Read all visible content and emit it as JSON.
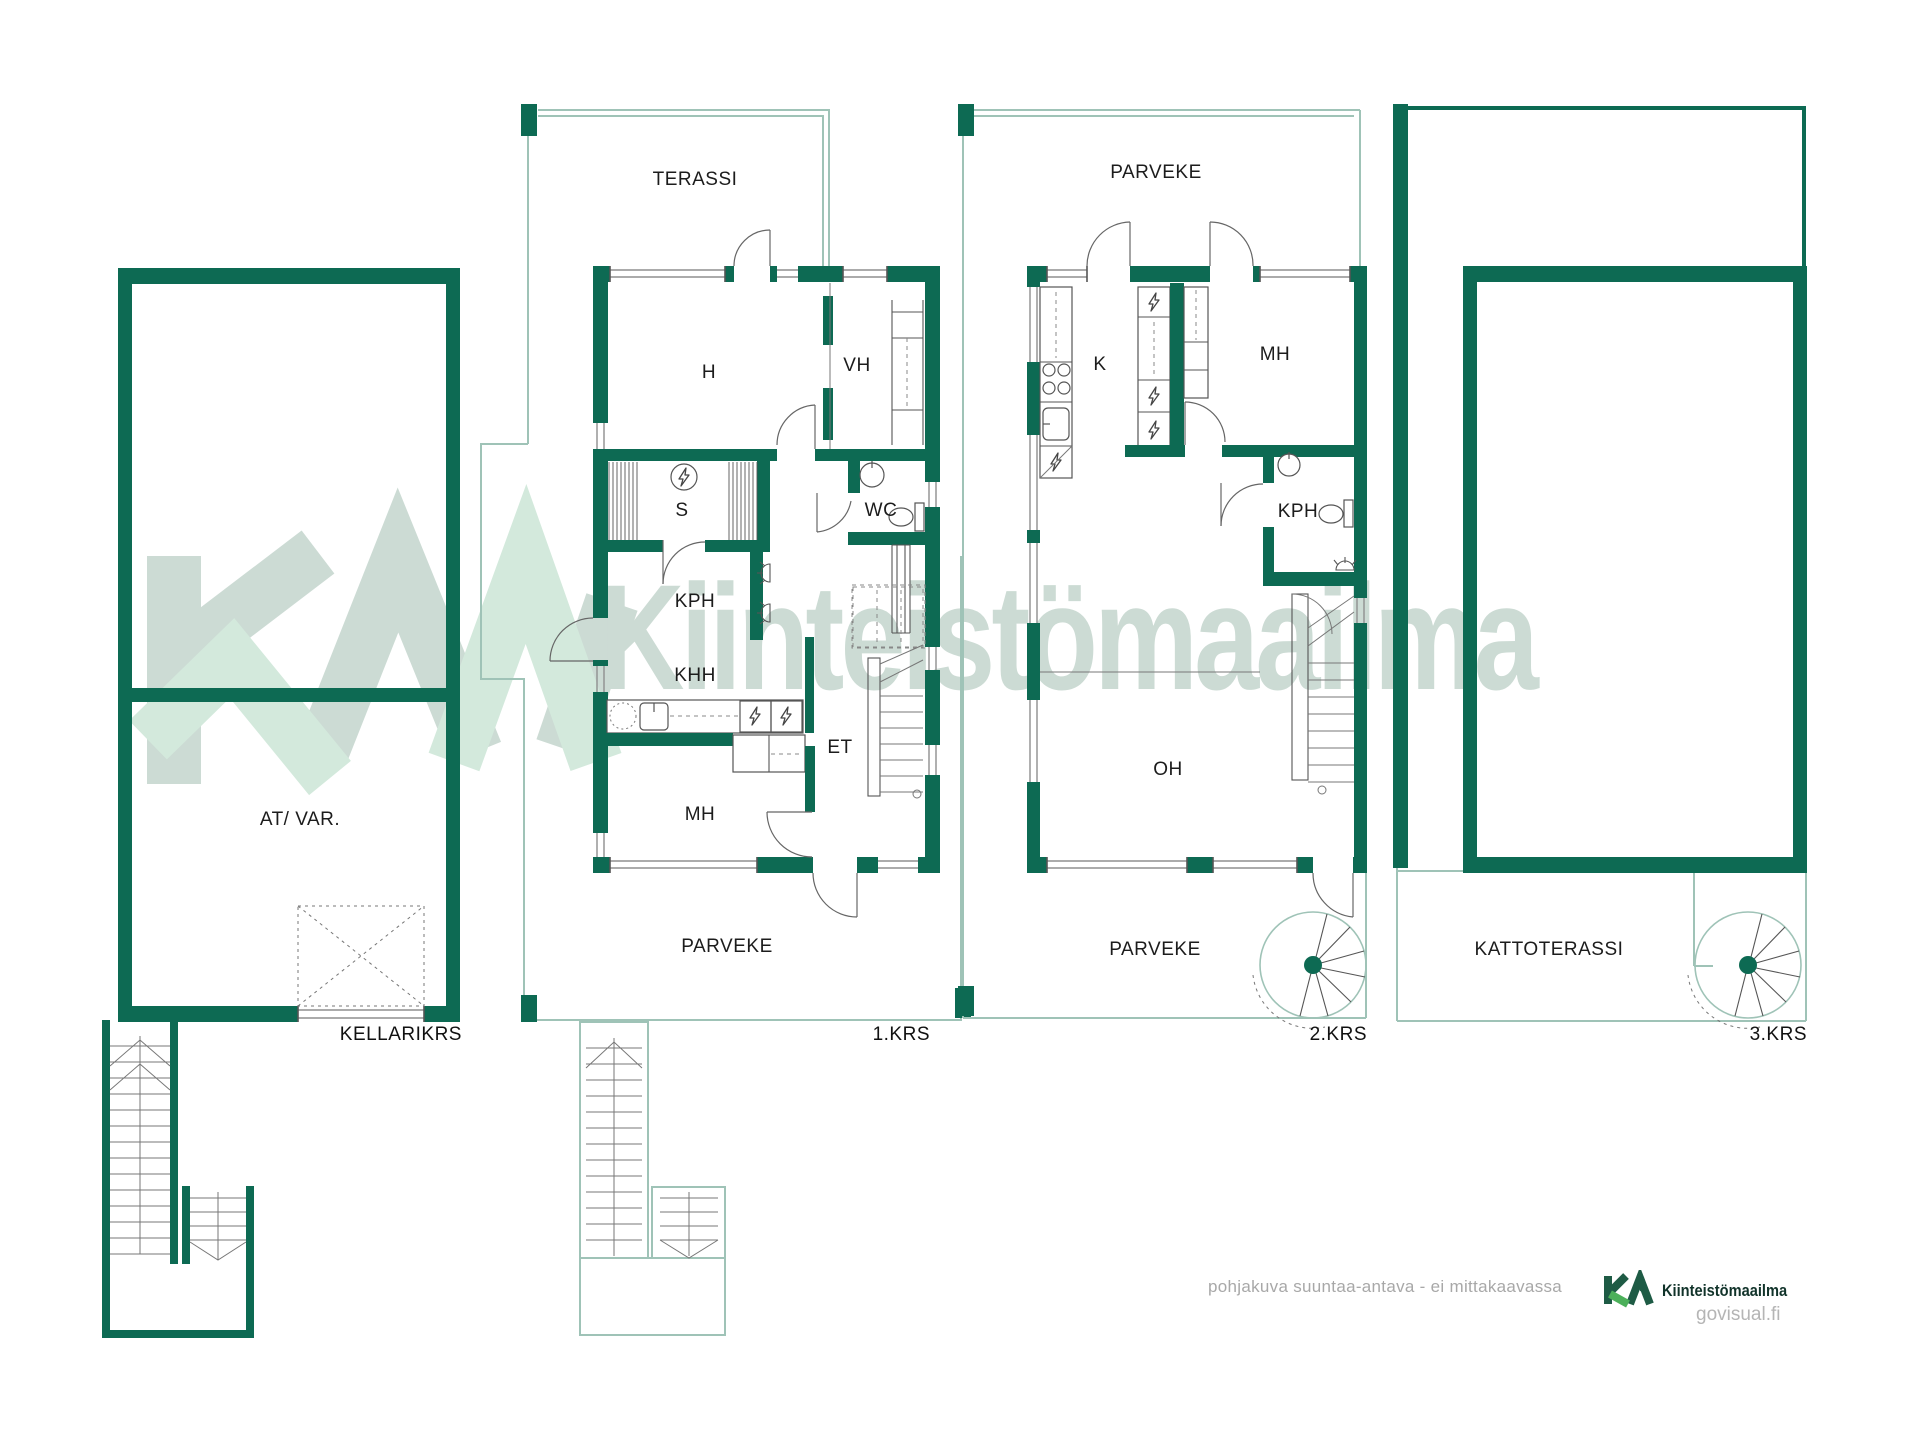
{
  "title": "Kiinteistomaailma floor plan",
  "colors": {
    "wall": "#0d6a53",
    "accent_green": "#4cb05a",
    "watermark_gray": "#ccdbd4",
    "watermark_mint": "#d3e9dc",
    "outline_light": "#9fc3b7",
    "brand_dark": "#11332a"
  },
  "watermark": {
    "text": "Kiinteistömaailma"
  },
  "floors": [
    {
      "name": "KELLARIKRS",
      "rooms": [
        "AT/ VAR."
      ]
    },
    {
      "name": "1.KRS",
      "rooms": [
        "TERASSI",
        "H",
        "VH",
        "S",
        "WC",
        "KPH",
        "KHH",
        "ET",
        "MH",
        "PARVEKE"
      ]
    },
    {
      "name": "2.KRS",
      "rooms": [
        "PARVEKE",
        "K",
        "MH",
        "KPH",
        "OH",
        "PARVEKE"
      ]
    },
    {
      "name": "3.KRS",
      "rooms": [
        "KATTOTERASSI"
      ]
    }
  ],
  "labels": {
    "kellarikrs": "KELLARIKRS",
    "krs1": "1.KRS",
    "krs2": "2.KRS",
    "krs3": "3.KRS",
    "at_var": "AT/ VAR.",
    "terassi": "TERASSI",
    "parveke": "PARVEKE",
    "h": "H",
    "vh": "VH",
    "s": "S",
    "wc": "WC",
    "kph": "KPH",
    "khh": "KHH",
    "et": "ET",
    "mh": "MH",
    "k": "K",
    "oh": "OH",
    "kattoterassi": "KATTOTERASSI"
  },
  "footer": {
    "disclaimer": "pohjakuva suuntaa-antava - ei mittakaavassa",
    "brand": "Kiinteistömaailma",
    "site": "govisual.fi"
  }
}
